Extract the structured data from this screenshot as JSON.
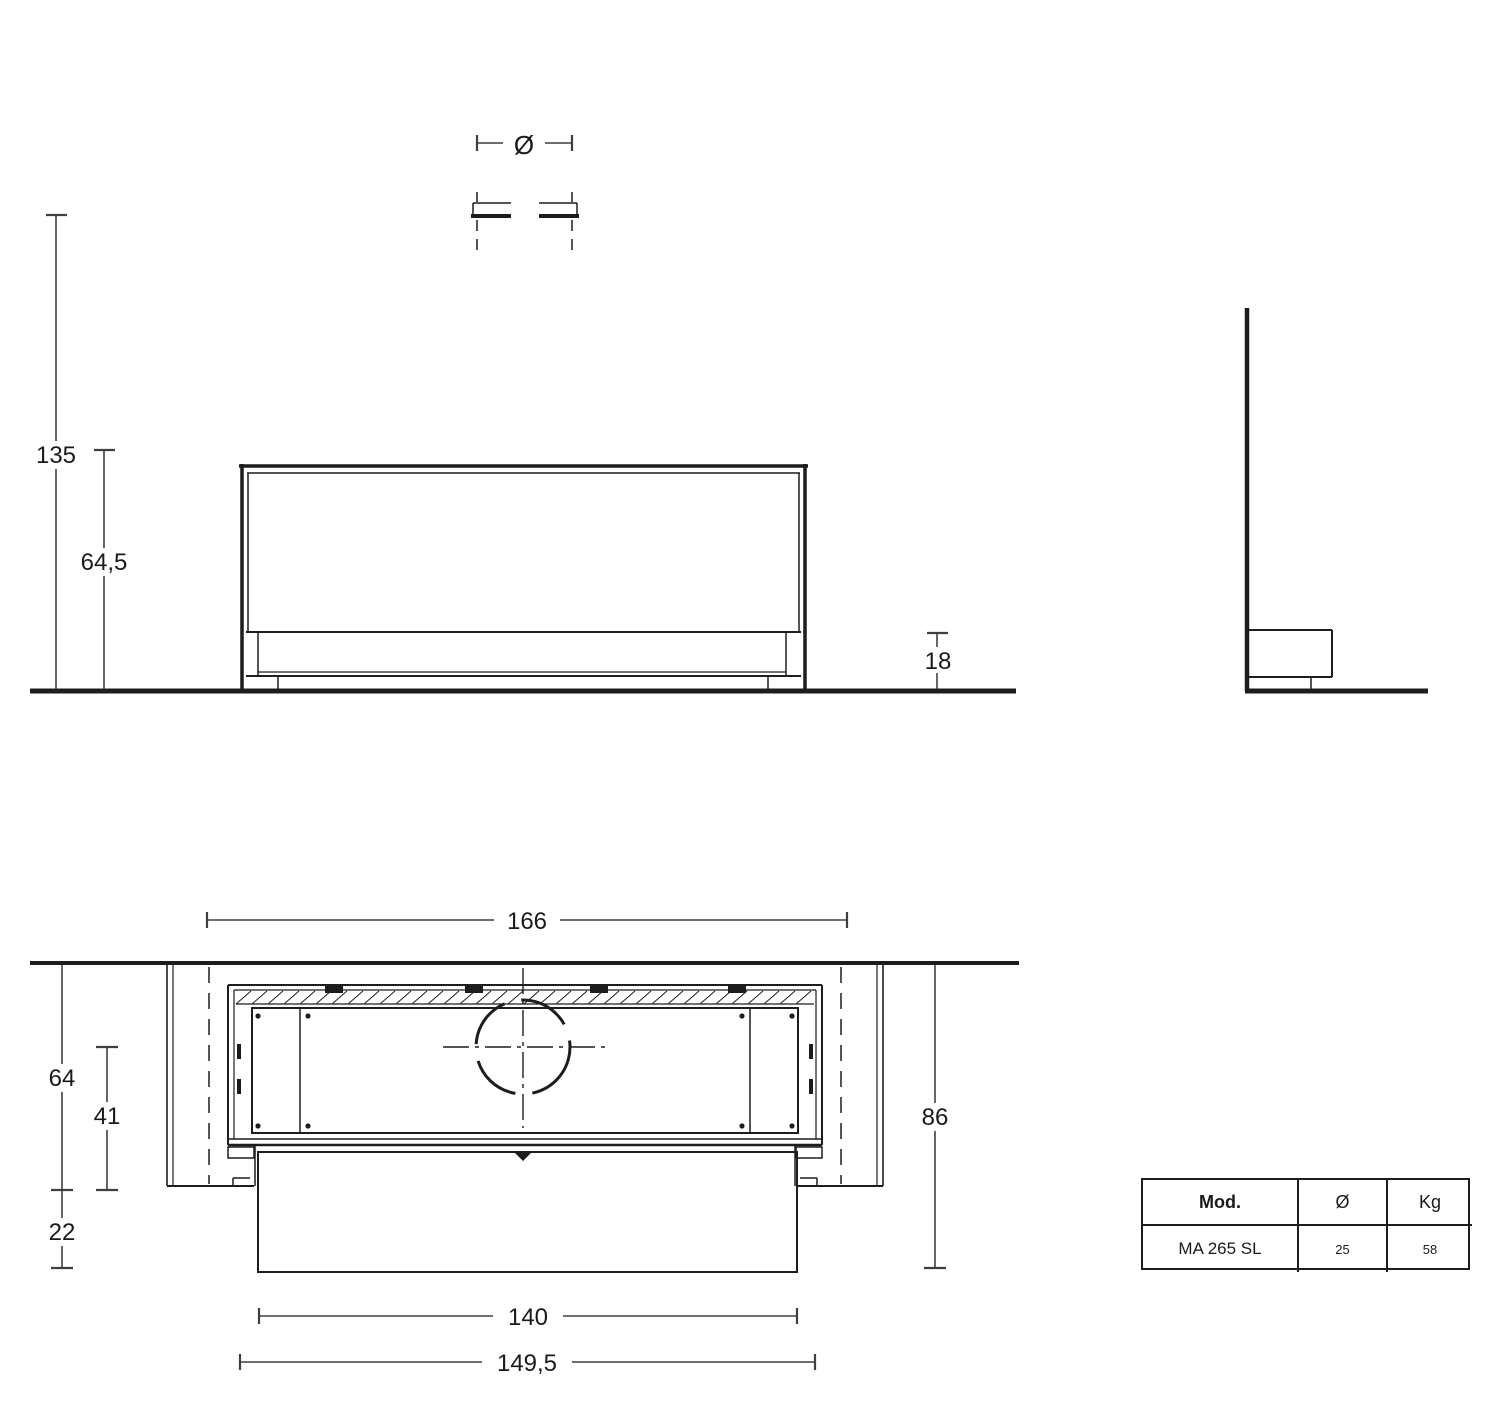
{
  "dimensions": {
    "flue_diameter_symbol": "Ø",
    "overall_height": "135",
    "glass_top_height": "64,5",
    "base_band_height": "18",
    "recess_width": "166",
    "recess_depth": "64",
    "flue_axis_to_front": "41",
    "front_overhang": "22",
    "overall_depth": "86",
    "front_panel_width": "140",
    "body_width": "149,5"
  },
  "spec_table": {
    "headers": {
      "model": "Mod.",
      "diameter": "Ø",
      "weight": "Kg"
    },
    "row": {
      "model": "MA 265 SL",
      "diameter": "25",
      "weight": "58"
    }
  },
  "colors": {
    "background": "#ffffff",
    "line": "#1d1d1d",
    "dimension_line": "#3f3f3f",
    "text": "#1a1a1a"
  }
}
